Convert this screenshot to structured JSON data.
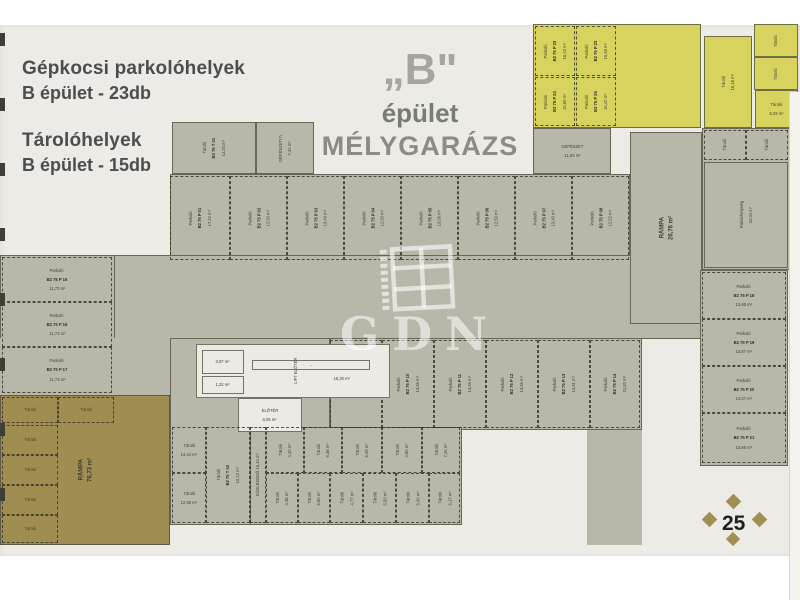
{
  "legend": {
    "parking_title": "Gépkocsi parkolóhelyek",
    "parking_value": "B épület - 23db",
    "storage_title": "Tárolóhelyek",
    "storage_value": "B épület - 15db"
  },
  "title": {
    "building": "„B\"",
    "line2": "épület",
    "line3": "MÉLYGARÁZS"
  },
  "watermark": {
    "text": "GDN"
  },
  "page": {
    "number": "25"
  },
  "colors": {
    "page_bg": "#edebe5",
    "floor_gray": "#b8b7a9",
    "zone_yellow": "#d8d25f",
    "zone_olive": "#a08d52",
    "wall": "#4b4c3c",
    "diamond_gold": "#a18e51"
  },
  "photo": {
    "tick_ys": [
      33,
      98,
      163,
      228,
      293,
      358,
      423,
      488
    ]
  },
  "plan": {
    "items": [
      {
        "n": "floor-row1-base",
        "x": 170,
        "y": 174,
        "w": 460,
        "h": 88,
        "f": "gray",
        "b": "solid"
      },
      {
        "n": "floor-aisle",
        "x": 0,
        "y": 255,
        "w": 702,
        "h": 84,
        "f": "gray",
        "b": "solid"
      },
      {
        "n": "floor-leftcol-base",
        "x": 0,
        "y": 255,
        "w": 115,
        "h": 140,
        "f": "gray",
        "b": "solid"
      },
      {
        "n": "floor-left-band",
        "x": 0,
        "y": 338,
        "w": 170,
        "h": 57,
        "f": "gray"
      },
      {
        "n": "floor-row2-base",
        "x": 330,
        "y": 338,
        "w": 312,
        "h": 92,
        "f": "gray",
        "b": "solid"
      },
      {
        "n": "floor-core-base",
        "x": 170,
        "y": 338,
        "w": 160,
        "h": 187,
        "f": "gray",
        "b": "solid"
      },
      {
        "n": "floor-storage-base",
        "x": 250,
        "y": 427,
        "w": 212,
        "h": 98,
        "f": "gray",
        "b": "solid"
      },
      {
        "n": "floor-right-strip",
        "x": 587,
        "y": 430,
        "w": 55,
        "h": 115,
        "f": "gray"
      },
      {
        "n": "room-rampa-upper",
        "x": 630,
        "y": 132,
        "w": 72,
        "h": 192,
        "f": "gray",
        "b": "solid",
        "r": true,
        "t": [
          "RÁMPA",
          "26,76 m²"
        ]
      },
      {
        "n": "floor-right-rooms-base",
        "x": 702,
        "y": 128,
        "w": 88,
        "h": 142,
        "f": "gray",
        "b": "solid"
      },
      {
        "n": "floor-rightcol-base",
        "x": 700,
        "y": 270,
        "w": 88,
        "h": 196,
        "f": "gray",
        "b": "solid"
      },
      {
        "n": "room-gepeszet",
        "x": 533,
        "y": 128,
        "w": 78,
        "h": 46,
        "f": "gray",
        "b": "solid",
        "t": [
          "GÉPÉSZET",
          "11,93 m²"
        ]
      },
      {
        "n": "room-taroló-top",
        "x": 172,
        "y": 122,
        "w": 84,
        "h": 52,
        "f": "gray",
        "b": "solid",
        "r": true,
        "t": [
          "Tároló",
          "B2 75 T 01",
          "13,20 m²"
        ]
      },
      {
        "n": "room-gepeszeti-top",
        "x": 256,
        "y": 122,
        "w": 58,
        "h": 52,
        "f": "gray",
        "b": "solid",
        "r": true,
        "t": [
          "GÉPÉSZETI h.",
          "7,32 m²"
        ]
      },
      {
        "n": "zone-yellow-parking",
        "x": 533,
        "y": 24,
        "w": 168,
        "h": 104,
        "f": "yellow",
        "b": "solid"
      },
      {
        "n": "parking-stall",
        "x": 535,
        "y": 26,
        "w": 40,
        "h": 50,
        "f": "none",
        "b": "dash",
        "r": true,
        "t": [
          "Parkoló",
          "B2 75 P 22",
          "16,42 m²"
        ]
      },
      {
        "n": "parking-stall",
        "x": 576,
        "y": 26,
        "w": 40,
        "h": 50,
        "f": "none",
        "b": "dash",
        "r": true,
        "t": [
          "Parkoló",
          "B2 75 P 23",
          "15,65 m²"
        ]
      },
      {
        "n": "parking-stall",
        "x": 535,
        "y": 77,
        "w": 40,
        "h": 49,
        "f": "none",
        "b": "dash",
        "r": true,
        "t": [
          "Parkoló",
          "B2 75 P 24",
          "15,65 m²"
        ]
      },
      {
        "n": "parking-stall",
        "x": 576,
        "y": 77,
        "w": 40,
        "h": 49,
        "f": "none",
        "b": "dash",
        "r": true,
        "t": [
          "Parkoló",
          "B2 75 P 25",
          "16,42 m²"
        ]
      },
      {
        "n": "room-yellow-taroló",
        "x": 704,
        "y": 36,
        "w": 48,
        "h": 92,
        "f": "yellow",
        "b": "solid",
        "r": true,
        "t": [
          "Tároló",
          "16,18 m²"
        ]
      },
      {
        "n": "room-yellow-cell",
        "x": 754,
        "y": 24,
        "w": 44,
        "h": 33,
        "f": "yellow",
        "b": "solid",
        "r": true,
        "t": [
          "Tároló"
        ]
      },
      {
        "n": "room-yellow-cell",
        "x": 754,
        "y": 57,
        "w": 44,
        "h": 33,
        "f": "yellow",
        "b": "solid",
        "r": true,
        "t": [
          "Tároló"
        ]
      },
      {
        "n": "room-yellow-cell",
        "x": 755,
        "y": 90,
        "w": 43,
        "h": 38,
        "f": "yellow",
        "b": "solid",
        "t": [
          "Tároló",
          "5,03 m²"
        ]
      },
      {
        "n": "zone-ramp-olive",
        "x": 0,
        "y": 395,
        "w": 170,
        "h": 150,
        "f": "olive",
        "b": "solid",
        "r": true,
        "t": [
          "RÁMPA",
          "76,73 m²"
        ]
      },
      {
        "n": "storage-cell-olive",
        "x": 2,
        "y": 397,
        "w": 56,
        "h": 26,
        "f": "none",
        "b": "dash",
        "t": [
          "Tároló"
        ]
      },
      {
        "n": "storage-cell-olive",
        "x": 58,
        "y": 397,
        "w": 56,
        "h": 26,
        "f": "none",
        "b": "dash",
        "t": [
          "Tároló"
        ]
      },
      {
        "n": "storage-cell-olive",
        "x": 2,
        "y": 425,
        "w": 56,
        "h": 30,
        "f": "none",
        "b": "dash",
        "t": [
          "Tároló"
        ]
      },
      {
        "n": "storage-cell-olive",
        "x": 2,
        "y": 455,
        "w": 56,
        "h": 30,
        "f": "none",
        "b": "dash",
        "t": [
          "Tároló"
        ]
      },
      {
        "n": "storage-cell-olive",
        "x": 2,
        "y": 485,
        "w": 56,
        "h": 30,
        "f": "none",
        "b": "dash",
        "t": [
          "Tároló"
        ]
      },
      {
        "n": "storage-cell-olive",
        "x": 2,
        "y": 515,
        "w": 56,
        "h": 28,
        "f": "none",
        "b": "dash",
        "t": [
          "Tároló"
        ]
      },
      {
        "n": "parking-stall",
        "x": 170,
        "y": 176,
        "w": 60,
        "h": 84,
        "f": "none",
        "b": "dash",
        "r": true,
        "t": [
          "Parkoló",
          "B2 75 P 01",
          "17,42 m²"
        ]
      },
      {
        "n": "parking-stall",
        "x": 230,
        "y": 176,
        "w": 57,
        "h": 84,
        "f": "none",
        "b": "dash",
        "r": true,
        "t": [
          "Parkoló",
          "B2 75 P 02",
          "12,50 m²"
        ]
      },
      {
        "n": "parking-stall",
        "x": 287,
        "y": 176,
        "w": 57,
        "h": 84,
        "f": "none",
        "b": "dash",
        "r": true,
        "t": [
          "Parkoló",
          "B2 75 P 03",
          "13,40 m²"
        ]
      },
      {
        "n": "parking-stall",
        "x": 344,
        "y": 176,
        "w": 57,
        "h": 84,
        "f": "none",
        "b": "dash",
        "r": true,
        "t": [
          "Parkoló",
          "B2 75 P 04",
          "12,50 m²"
        ]
      },
      {
        "n": "parking-stall",
        "x": 401,
        "y": 176,
        "w": 57,
        "h": 84,
        "f": "none",
        "b": "dash",
        "r": true,
        "t": [
          "Parkoló",
          "B2 75 P 05",
          "13,06 m²"
        ]
      },
      {
        "n": "parking-stall",
        "x": 458,
        "y": 176,
        "w": 57,
        "h": 84,
        "f": "none",
        "b": "dash",
        "r": true,
        "t": [
          "Parkoló",
          "B2 75 P 06",
          "12,50 m²"
        ]
      },
      {
        "n": "parking-stall",
        "x": 515,
        "y": 176,
        "w": 57,
        "h": 84,
        "f": "none",
        "b": "dash",
        "r": true,
        "t": [
          "Parkoló",
          "B2 75 P 07",
          "13,40 m²"
        ]
      },
      {
        "n": "parking-stall",
        "x": 572,
        "y": 176,
        "w": 57,
        "h": 84,
        "f": "none",
        "b": "dash",
        "r": true,
        "t": [
          "Parkoló",
          "B2 75 P 08",
          "12,52 m²"
        ]
      },
      {
        "n": "parking-stall",
        "x": 330,
        "y": 340,
        "w": 52,
        "h": 88,
        "f": "none",
        "b": "dash",
        "r": true,
        "t": [
          "Parkoló",
          "B2 75 P 09",
          "13,06 m²"
        ]
      },
      {
        "n": "parking-stall",
        "x": 382,
        "y": 340,
        "w": 52,
        "h": 88,
        "f": "none",
        "b": "dash",
        "r": true,
        "t": [
          "Parkoló",
          "B2 75 P 10",
          "13,06 m²"
        ]
      },
      {
        "n": "parking-stall",
        "x": 434,
        "y": 340,
        "w": 52,
        "h": 88,
        "f": "none",
        "b": "dash",
        "r": true,
        "t": [
          "Parkoló",
          "B2 75 P 11",
          "13,06 m²"
        ]
      },
      {
        "n": "parking-stall",
        "x": 486,
        "y": 340,
        "w": 52,
        "h": 88,
        "f": "none",
        "b": "dash",
        "r": true,
        "t": [
          "Parkoló",
          "B2 75 P 12",
          "13,06 m²"
        ]
      },
      {
        "n": "parking-stall",
        "x": 538,
        "y": 340,
        "w": 52,
        "h": 88,
        "f": "none",
        "b": "dash",
        "r": true,
        "t": [
          "Parkoló",
          "B2 75 P 13",
          "13,91 m²"
        ]
      },
      {
        "n": "parking-stall",
        "x": 590,
        "y": 340,
        "w": 50,
        "h": 88,
        "f": "none",
        "b": "dash",
        "r": true,
        "t": [
          "Parkoló",
          "B2 75 P 14",
          "21,82 m²"
        ]
      },
      {
        "n": "parking-stall",
        "x": 2,
        "y": 257,
        "w": 110,
        "h": 45,
        "f": "none",
        "b": "dash",
        "t": [
          "Parkoló",
          "B2 75 P 15",
          "11,73 m²"
        ]
      },
      {
        "n": "parking-stall",
        "x": 2,
        "y": 302,
        "w": 110,
        "h": 45,
        "f": "none",
        "b": "dash",
        "t": [
          "Parkoló",
          "B2 75 P 16",
          "11,73 m²"
        ]
      },
      {
        "n": "parking-stall",
        "x": 2,
        "y": 347,
        "w": 110,
        "h": 46,
        "f": "none",
        "b": "dash",
        "t": [
          "Parkoló",
          "B2 75 P 17",
          "11,73 m²"
        ]
      },
      {
        "n": "parking-stall",
        "x": 702,
        "y": 272,
        "w": 84,
        "h": 47,
        "f": "none",
        "b": "dash",
        "t": [
          "Parkoló",
          "B2 75 P 18",
          "13,65 m²"
        ]
      },
      {
        "n": "parking-stall",
        "x": 702,
        "y": 319,
        "w": 84,
        "h": 47,
        "f": "none",
        "b": "dash",
        "t": [
          "Parkoló",
          "B2 75 P 19",
          "13,67 m²"
        ]
      },
      {
        "n": "parking-stall",
        "x": 702,
        "y": 366,
        "w": 84,
        "h": 47,
        "f": "none",
        "b": "dash",
        "t": [
          "Parkoló",
          "B2 75 P 20",
          "13,67 m²"
        ]
      },
      {
        "n": "parking-stall",
        "x": 702,
        "y": 413,
        "w": 84,
        "h": 50,
        "f": "none",
        "b": "dash",
        "t": [
          "Parkoló",
          "B2 75 P 21",
          "13,65 m²"
        ]
      },
      {
        "n": "storage-cell",
        "x": 704,
        "y": 130,
        "w": 42,
        "h": 30,
        "f": "none",
        "b": "dash",
        "r": true,
        "t": [
          "Tároló"
        ]
      },
      {
        "n": "storage-cell",
        "x": 746,
        "y": 130,
        "w": 42,
        "h": 30,
        "f": "none",
        "b": "dash",
        "r": true,
        "t": [
          "Tároló"
        ]
      },
      {
        "n": "room-raktar",
        "x": 704,
        "y": 162,
        "w": 84,
        "h": 106,
        "f": "none",
        "b": "solid",
        "r": true,
        "t": [
          "Raktárhelyiség",
          "34,04 m²"
        ]
      },
      {
        "n": "room-core",
        "x": 196,
        "y": 344,
        "w": 194,
        "h": 54,
        "f": "white",
        "b": "solid"
      },
      {
        "n": "room-core-cell",
        "x": 202,
        "y": 350,
        "w": 42,
        "h": 24,
        "f": "none",
        "b": "solid",
        "t": [
          "3,97 m²"
        ]
      },
      {
        "n": "room-core-cell",
        "x": 202,
        "y": 376,
        "w": 42,
        "h": 18,
        "f": "none",
        "b": "solid",
        "t": [
          "1,22 m²"
        ]
      },
      {
        "n": "stair-run",
        "x": 252,
        "y": 360,
        "w": 118,
        "h": 10,
        "f": "none",
        "b": "solid",
        "t": [
          "→"
        ]
      },
      {
        "n": "label-lift-lobby",
        "x": 288,
        "y": 344,
        "w": 16,
        "h": 54,
        "f": "none",
        "b": "none",
        "r": true,
        "t": [
          "LIFT ELŐTÉR"
        ]
      },
      {
        "n": "label-stair-area",
        "x": 312,
        "y": 372,
        "w": 60,
        "h": 14,
        "f": "none",
        "b": "none",
        "t": [
          "18,20 m²"
        ]
      },
      {
        "n": "room-eloter",
        "x": 238,
        "y": 398,
        "w": 64,
        "h": 34,
        "f": "white",
        "b": "solid",
        "t": [
          "ELŐTÉR",
          "8,05 m²"
        ]
      },
      {
        "n": "storage-cell",
        "x": 172,
        "y": 427,
        "w": 34,
        "h": 46,
        "f": "none",
        "b": "dash",
        "t": [
          "Tároló",
          "14,44 m²"
        ]
      },
      {
        "n": "storage-cell",
        "x": 172,
        "y": 473,
        "w": 34,
        "h": 50,
        "f": "none",
        "b": "dash",
        "t": [
          "Tároló",
          "12,06 m²"
        ]
      },
      {
        "n": "storage-cell",
        "x": 206,
        "y": 427,
        "w": 44,
        "h": 96,
        "f": "none",
        "b": "dash",
        "r": true,
        "t": [
          "Tároló",
          "B2 75 T 03",
          "10,13 m²"
        ]
      },
      {
        "n": "corridor-kozlekedo",
        "x": 250,
        "y": 427,
        "w": 16,
        "h": 96,
        "f": "none",
        "b": "dash",
        "r": true,
        "t": [
          "KÖZLEKEDŐ 16,40 m²"
        ]
      },
      {
        "n": "storage-cell",
        "x": 266,
        "y": 427,
        "w": 38,
        "h": 46,
        "f": "none",
        "b": "dash",
        "r": true,
        "t": [
          "Tároló",
          "4,40 m²"
        ]
      },
      {
        "n": "storage-cell",
        "x": 304,
        "y": 427,
        "w": 38,
        "h": 46,
        "f": "none",
        "b": "dash",
        "r": true,
        "t": [
          "Tároló",
          "5,38 m²"
        ]
      },
      {
        "n": "storage-cell",
        "x": 342,
        "y": 427,
        "w": 40,
        "h": 46,
        "f": "none",
        "b": "dash",
        "r": true,
        "t": [
          "Tároló",
          "5,39 m²"
        ]
      },
      {
        "n": "storage-cell",
        "x": 382,
        "y": 427,
        "w": 40,
        "h": 46,
        "f": "none",
        "b": "dash",
        "r": true,
        "t": [
          "Tároló",
          "4,80 m²"
        ]
      },
      {
        "n": "storage-cell",
        "x": 422,
        "y": 427,
        "w": 38,
        "h": 46,
        "f": "none",
        "b": "dash",
        "r": true,
        "t": [
          "Tároló",
          "7,46 m²"
        ]
      },
      {
        "n": "storage-cell",
        "x": 266,
        "y": 473,
        "w": 32,
        "h": 50,
        "f": "none",
        "b": "dash",
        "r": true,
        "t": [
          "Tároló",
          "4,38 m²"
        ]
      },
      {
        "n": "storage-cell",
        "x": 298,
        "y": 473,
        "w": 32,
        "h": 50,
        "f": "none",
        "b": "dash",
        "r": true,
        "t": [
          "Tároló",
          "5,80 m²"
        ]
      },
      {
        "n": "storage-cell",
        "x": 330,
        "y": 473,
        "w": 33,
        "h": 50,
        "f": "none",
        "b": "dash",
        "r": true,
        "t": [
          "Tároló",
          "4,77 m²"
        ]
      },
      {
        "n": "storage-cell",
        "x": 363,
        "y": 473,
        "w": 33,
        "h": 50,
        "f": "none",
        "b": "dash",
        "r": true,
        "t": [
          "Tároló",
          "5,00 m²"
        ]
      },
      {
        "n": "storage-cell",
        "x": 396,
        "y": 473,
        "w": 33,
        "h": 50,
        "f": "none",
        "b": "dash",
        "r": true,
        "t": [
          "Tároló",
          "5,40 m²"
        ]
      },
      {
        "n": "storage-cell",
        "x": 429,
        "y": 473,
        "w": 31,
        "h": 50,
        "f": "none",
        "b": "dash",
        "r": true,
        "t": [
          "Tároló",
          "6,17 m²"
        ]
      }
    ]
  }
}
